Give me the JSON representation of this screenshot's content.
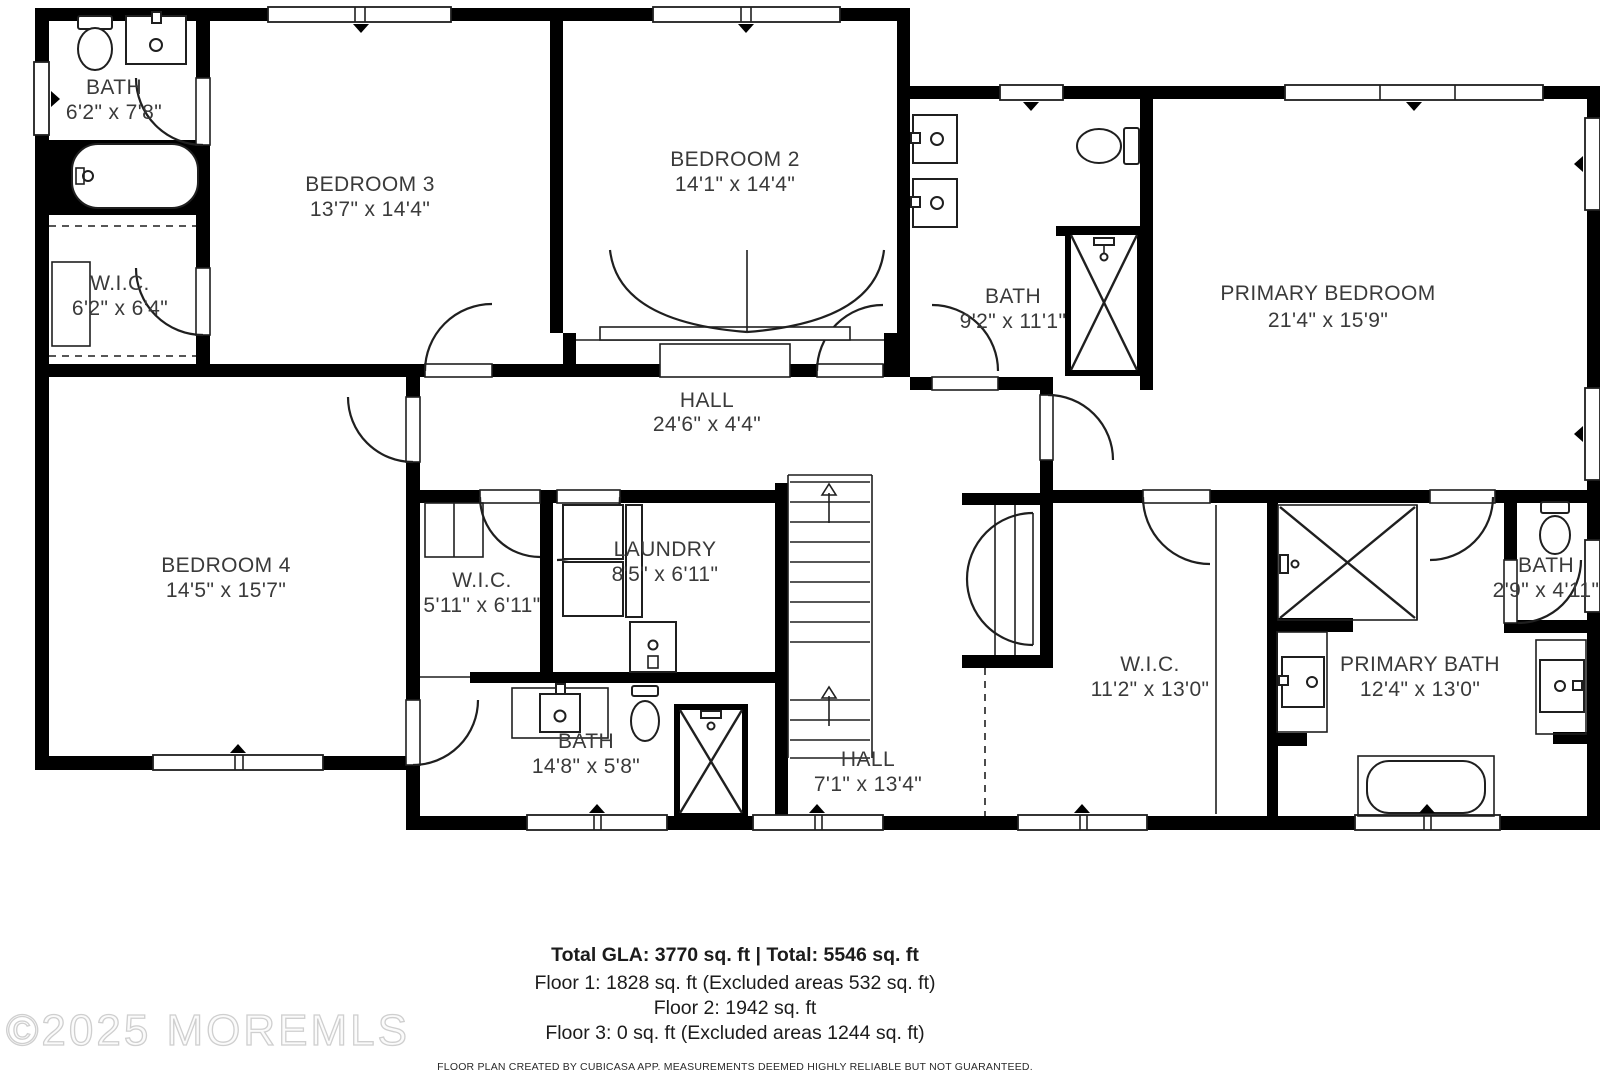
{
  "rooms": [
    {
      "id": "bath-upper-left",
      "name": "BATH",
      "dims": "6'2\" x 7'8\""
    },
    {
      "id": "wic-upper-left",
      "name": "W.I.C.",
      "dims": "6'2\" x 6'4\""
    },
    {
      "id": "bedroom-3",
      "name": "BEDROOM 3",
      "dims": "13'7\" x 14'4\""
    },
    {
      "id": "bedroom-2",
      "name": "BEDROOM 2",
      "dims": "14'1\" x 14'4\""
    },
    {
      "id": "bath-center",
      "name": "BATH",
      "dims": "9'2\" x 11'1\""
    },
    {
      "id": "primary-bedroom",
      "name": "PRIMARY BEDROOM",
      "dims": "21'4\" x 15'9\""
    },
    {
      "id": "hall-upper",
      "name": "HALL",
      "dims": "24'6\" x 4'4\""
    },
    {
      "id": "bedroom-4",
      "name": "BEDROOM 4",
      "dims": "14'5\" x 15'7\""
    },
    {
      "id": "wic-small",
      "name": "W.I.C.",
      "dims": "5'11\" x 6'11\""
    },
    {
      "id": "laundry",
      "name": "LAUNDRY",
      "dims": "8'5\" x 6'11\""
    },
    {
      "id": "bath-lower",
      "name": "BATH",
      "dims": "14'8\" x 5'8\""
    },
    {
      "id": "hall-lower",
      "name": "HALL",
      "dims": "7'1\" x 13'4\""
    },
    {
      "id": "wic-primary",
      "name": "W.I.C.",
      "dims": "11'2\" x 13'0\""
    },
    {
      "id": "primary-bath",
      "name": "PRIMARY BATH",
      "dims": "12'4\" x 13'0\""
    },
    {
      "id": "bath-small",
      "name": "BATH",
      "dims": "2'9\" x 4'11\""
    }
  ],
  "footer": {
    "total_line": "Total GLA: 3770 sq. ft | Total: 5546 sq. ft",
    "floor1": "Floor 1: 1828 sq. ft (Excluded areas 532 sq. ft)",
    "floor2": "Floor 2: 1942 sq. ft",
    "floor3": "Floor 3: 0 sq. ft (Excluded areas 1244 sq. ft)",
    "disclaimer": "FLOOR PLAN CREATED BY CUBICASA APP. MEASUREMENTS DEEMED HIGHLY RELIABLE BUT NOT GUARANTEED."
  },
  "watermark": "©2025 MOREMLS",
  "fixtures": [
    "toilet-icon",
    "sink-icon",
    "bathtub-icon",
    "shower-icon",
    "washer-dryer-icon",
    "stairs-icon",
    "door-arc",
    "window"
  ],
  "colors": {
    "wall": "#000000",
    "label": "#3a3a3a",
    "watermark_outline": "#cfcfcf"
  }
}
